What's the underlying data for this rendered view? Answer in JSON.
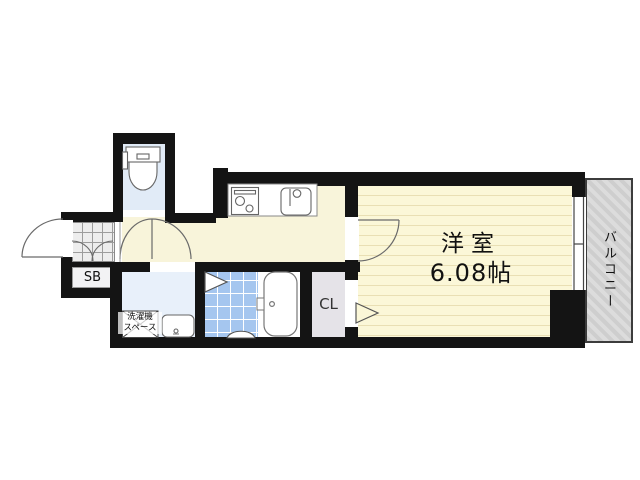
{
  "plan": {
    "type": "apartment-floor-plan",
    "rooms": {
      "western_room": {
        "name": "洋室",
        "area": "6.08帖"
      },
      "balcony": {
        "label": "バルコニー"
      },
      "closet": {
        "label": "CL"
      },
      "shoe_box": {
        "label": "SB"
      },
      "laundry_space": {
        "line1": "洗濯機",
        "line2": "スペース"
      }
    },
    "colors": {
      "wall": "#141414",
      "hallway_floor": "#f8f4da",
      "room_floor": "#fbf7d8",
      "room_stripe": "#e9dfb4",
      "bath_tile": "#a5c6ef",
      "washroom_floor": "#e8f0fa",
      "toilet_room": "#e1ebf7",
      "closet_floor": "#e5e3e8",
      "genkan_tile": "#ededed",
      "balcony": "#cecece"
    }
  }
}
